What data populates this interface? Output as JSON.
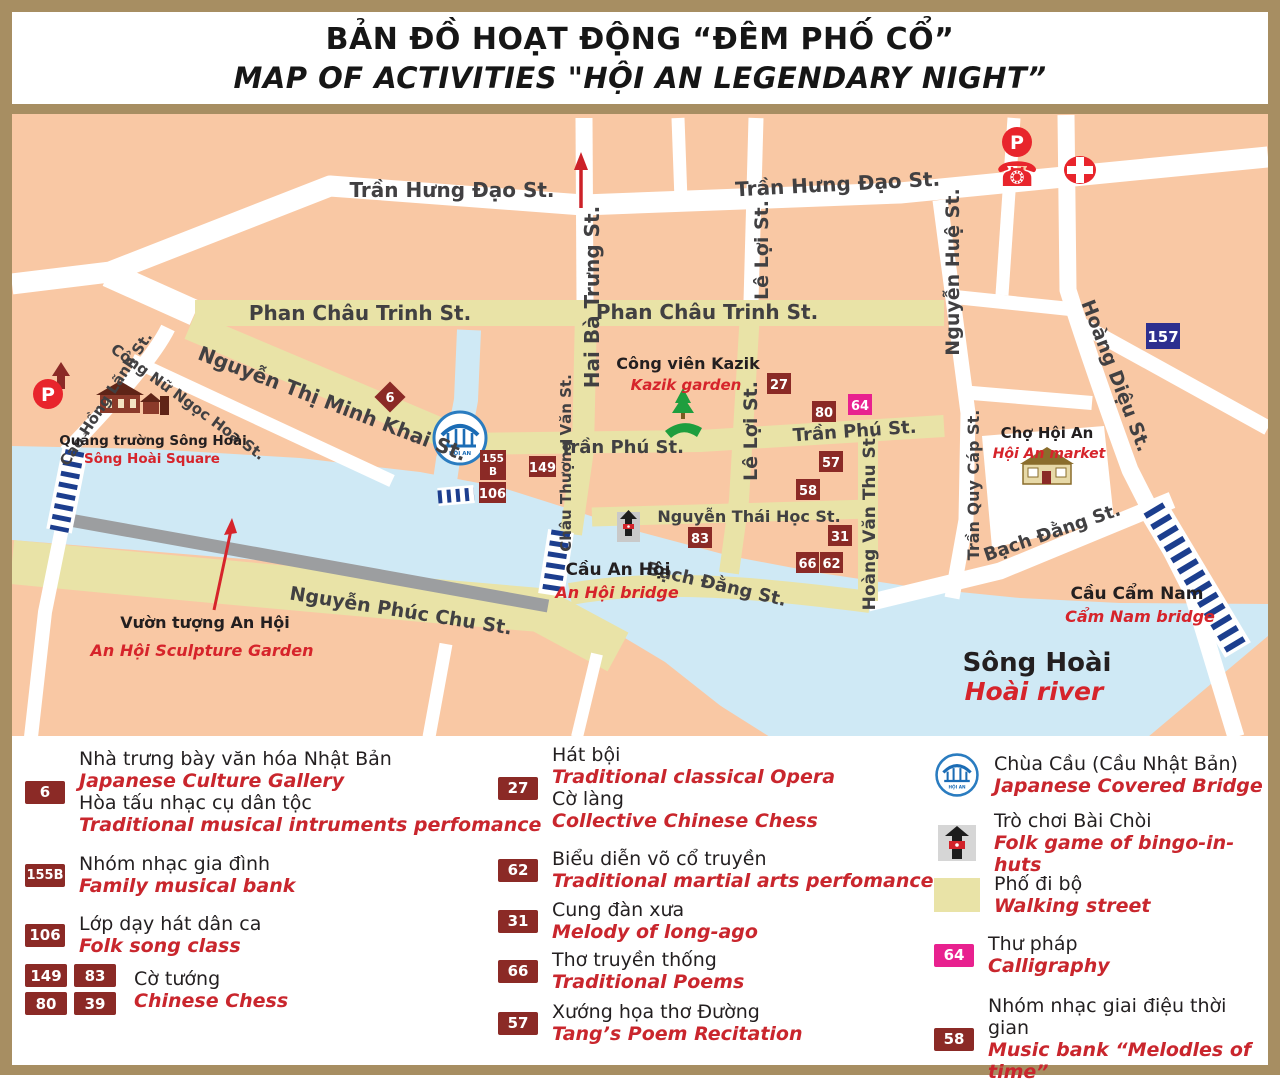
{
  "title": {
    "line1_vi": "BẢN ĐỒ HOẠT ĐỘNG “ĐÊM PHỐ CỔ”",
    "line2_en": "MAP OF ACTIVITIES \"HỘI AN LEGENDARY NIGHT”"
  },
  "map": {
    "streets": {
      "tran_hung_dao": "Trần Hưng Đạo St.",
      "phan_chau_trinh": "Phan Châu Trinh St.",
      "nguyen_thi_minh_khai": "Nguyễn Thị Minh Khai St.",
      "hai_ba_trung": "Hai Bà Trưng St.",
      "le_loi": "Lê Lợi St.",
      "nguyen_hue": "Nguyễn Huệ St.",
      "hoang_dieu": "Hoàng Diệu St.",
      "tran_phu": "Trần Phú St.",
      "chau_thuong_van": "Châu Thượng Văn St.",
      "hoang_van_thu": "Hoàng Văn Thu St.",
      "nguyen_thai_hoc": "Nguyễn Thái Học St.",
      "bach_dang": "Bạch Đằng St.",
      "tran_quy_cap": "Trần Quy Cáp St.",
      "nguyen_phuc_chu": "Nguyễn Phúc Chu St.",
      "cao_hong_lanh": "Cao Hồng Lãnh St.",
      "cong_nu_ngoc_hoa": "Công Nữ Ngọc Hoa St."
    },
    "places": {
      "kazik_vi": "Công viên Kazik",
      "kazik_en": "Kazik garden",
      "square_vi": "Quảng trường Sông Hoài",
      "square_en": "Sông Hoài Square",
      "market_vi": "Chợ Hội An",
      "market_en": "Hội An market",
      "anhoi_bridge_vi": "Cầu An Hội",
      "anhoi_bridge_en": "An Hội bridge",
      "camnam_bridge_vi": "Cầu Cẩm Nam",
      "camnam_bridge_en": "Cẩm Nam bridge",
      "river_vi": "Sông Hoài",
      "river_en": "Hoài river",
      "sculpture_vi": "Vườn tượng An Hội",
      "sculpture_en": "An Hội Sculpture Garden"
    },
    "markers": {
      "m6": "6",
      "m27": "27",
      "m80": "80",
      "m64": "64",
      "m57": "57",
      "m58": "58",
      "m83": "83",
      "m31": "31",
      "m66": "66",
      "m62": "62",
      "m149": "149",
      "m106": "106",
      "m155b_top": "155",
      "m155b_bottom": "B",
      "m157": "157"
    },
    "icons": {
      "parking": "P",
      "phone": "☎",
      "bridge_text": "HỘI AN"
    }
  },
  "legend": {
    "japanese_culture": {
      "badge": "6",
      "vi1": "Nhà trưng bày văn hóa Nhật Bản",
      "en1": "Japanese Culture Gallery",
      "vi2": "Hòa tấu nhạc cụ dân tộc",
      "en2": "Traditional musical intruments perfomance"
    },
    "family_band": {
      "badge": "155B",
      "vi": "Nhóm nhạc gia đình",
      "en": "Family musical bank"
    },
    "folk_song": {
      "badge": "106",
      "vi": "Lớp dạy hát dân ca",
      "en": "Folk song class"
    },
    "chinese_chess": {
      "badges": [
        "149",
        "83",
        "80",
        "39"
      ],
      "vi": "Cờ tướng",
      "en": "Chinese Chess"
    },
    "opera": {
      "badge": "27",
      "vi1": "Hát bội",
      "en1": "Traditional classical Opera",
      "vi2": "Cờ làng",
      "en2": "Collective Chinese Chess"
    },
    "martial": {
      "badge": "62",
      "vi": "Biểu diễn võ cổ truyền",
      "en": "Traditional martial arts perfomance"
    },
    "melody": {
      "badge": "31",
      "vi": "Cung đàn xưa",
      "en": "Melody of long-ago"
    },
    "poems": {
      "badge": "66",
      "vi": "Thơ truyền thống",
      "en": "Traditional Poems"
    },
    "tang_poem": {
      "badge": "57",
      "vi": "Xướng họa thơ Đường",
      "en": "Tang’s Poem Recitation"
    },
    "covered_bridge": {
      "vi": "Chùa Cầu (Cầu Nhật Bản)",
      "en": "Japanese Covered Bridge"
    },
    "bai_choi": {
      "vi": "Trò chơi Bài Chòi",
      "en": "Folk game of bingo-in-huts"
    },
    "walking_street": {
      "vi": "Phố đi bộ",
      "en": "Walking street"
    },
    "calligraphy": {
      "badge": "64",
      "vi": "Thư pháp",
      "en": "Calligraphy"
    },
    "music_bank": {
      "badge": "58",
      "vi": "Nhóm nhạc giai điệu thời gian",
      "en": "Music bank “Melodles of time”"
    }
  },
  "colors": {
    "frame": "#a78e62",
    "map_bg": "#f9c8a4",
    "walking_street": "#e9e3a7",
    "river": "#cfe9f5",
    "badge_maroon": "#8b2a26",
    "badge_magenta": "#e8218f",
    "badge_navy": "#2d2f8f",
    "accent_red": "#d6242b",
    "bridge_stripe_navy": "#1c3e8e"
  }
}
